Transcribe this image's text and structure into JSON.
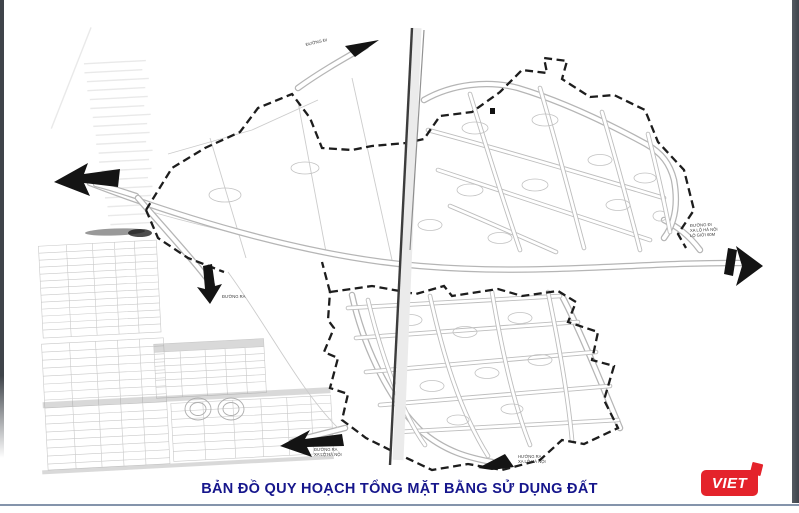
{
  "page": {
    "kind": "scanned land-use planning map",
    "background": "#ffffff"
  },
  "caption": {
    "title": "BẢN ĐỒ QUY HOẠCH TỔNG MẶT BẰNG SỬ DỤNG ĐẤT",
    "color": "#16168c",
    "rule_color": "#8494ab"
  },
  "logo": {
    "text": "VIET",
    "background": "#e4232b",
    "text_color": "#ffffff"
  },
  "map": {
    "boundary_style": "black dashed planning boundary",
    "road_color": "#b5b5b5",
    "fold_line": "dark vertical paper crease near center",
    "labels": [
      {
        "name": "top-road-label",
        "text": "ĐƯỜNG ĐI"
      },
      {
        "name": "right-road-label-1",
        "text": "ĐƯỜNG ĐI"
      },
      {
        "name": "right-road-label-2",
        "text": "XA LỘ HÀ NỘI"
      },
      {
        "name": "right-road-label-3",
        "text": "LỘ GIỚI 60M"
      },
      {
        "name": "mid-road-label",
        "text": "ĐƯỜNG RA"
      },
      {
        "name": "bottomleft-road-label-1",
        "text": "ĐƯỜNG RA"
      },
      {
        "name": "bottomleft-road-label-2",
        "text": "XA LỘ HÀ NỘI"
      },
      {
        "name": "bottom-road-label-1",
        "text": "HƯỚNG RA"
      },
      {
        "name": "bottom-road-label-2",
        "text": "XA LỘ HÀ NỘI"
      }
    ]
  }
}
